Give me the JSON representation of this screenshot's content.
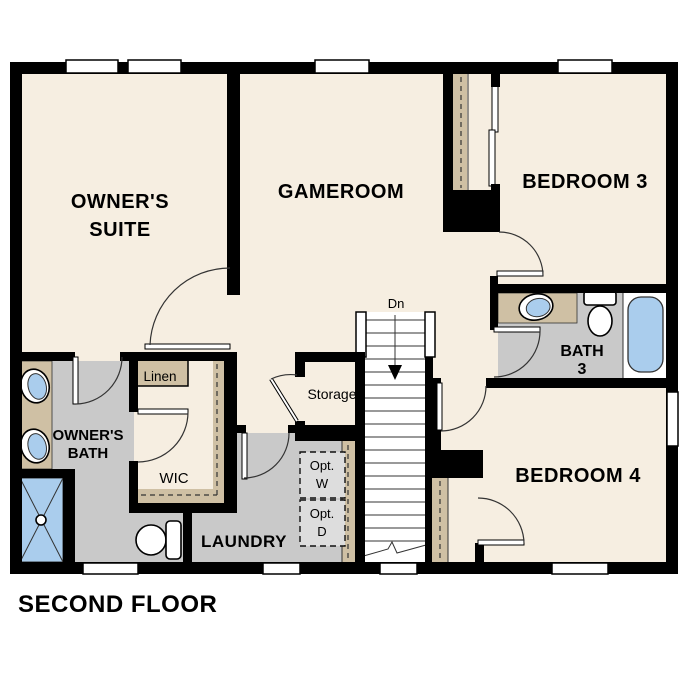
{
  "title": "SECOND FLOOR",
  "rooms": {
    "owners_suite": {
      "line1": "OWNER'S",
      "line2": "SUITE"
    },
    "gameroom": {
      "label": "GAMEROOM"
    },
    "bedroom3": {
      "label": "BEDROOM 3"
    },
    "bedroom4": {
      "label": "BEDROOM 4"
    },
    "bath3": {
      "line1": "BATH",
      "line2": "3"
    },
    "owners_bath": {
      "line1": "OWNER'S",
      "line2": "BATH"
    },
    "wic": {
      "label": "WIC"
    },
    "laundry": {
      "label": "LAUNDRY"
    },
    "storage": {
      "label": "Storage"
    },
    "linen": {
      "label": "Linen"
    }
  },
  "stairs": {
    "direction_label": "Dn"
  },
  "appliances": {
    "washer": {
      "line1": "Opt.",
      "line2": "W"
    },
    "dryer": {
      "line1": "Opt.",
      "line2": "D"
    }
  },
  "colors": {
    "wall": "#000000",
    "floor": "#f6eee1",
    "tile_gray": "#c9c9c9",
    "counter_tan": "#cfc0a4",
    "fixture_blue": "#aacded",
    "appliance_gray": "#dddddd",
    "line": "#333333"
  }
}
